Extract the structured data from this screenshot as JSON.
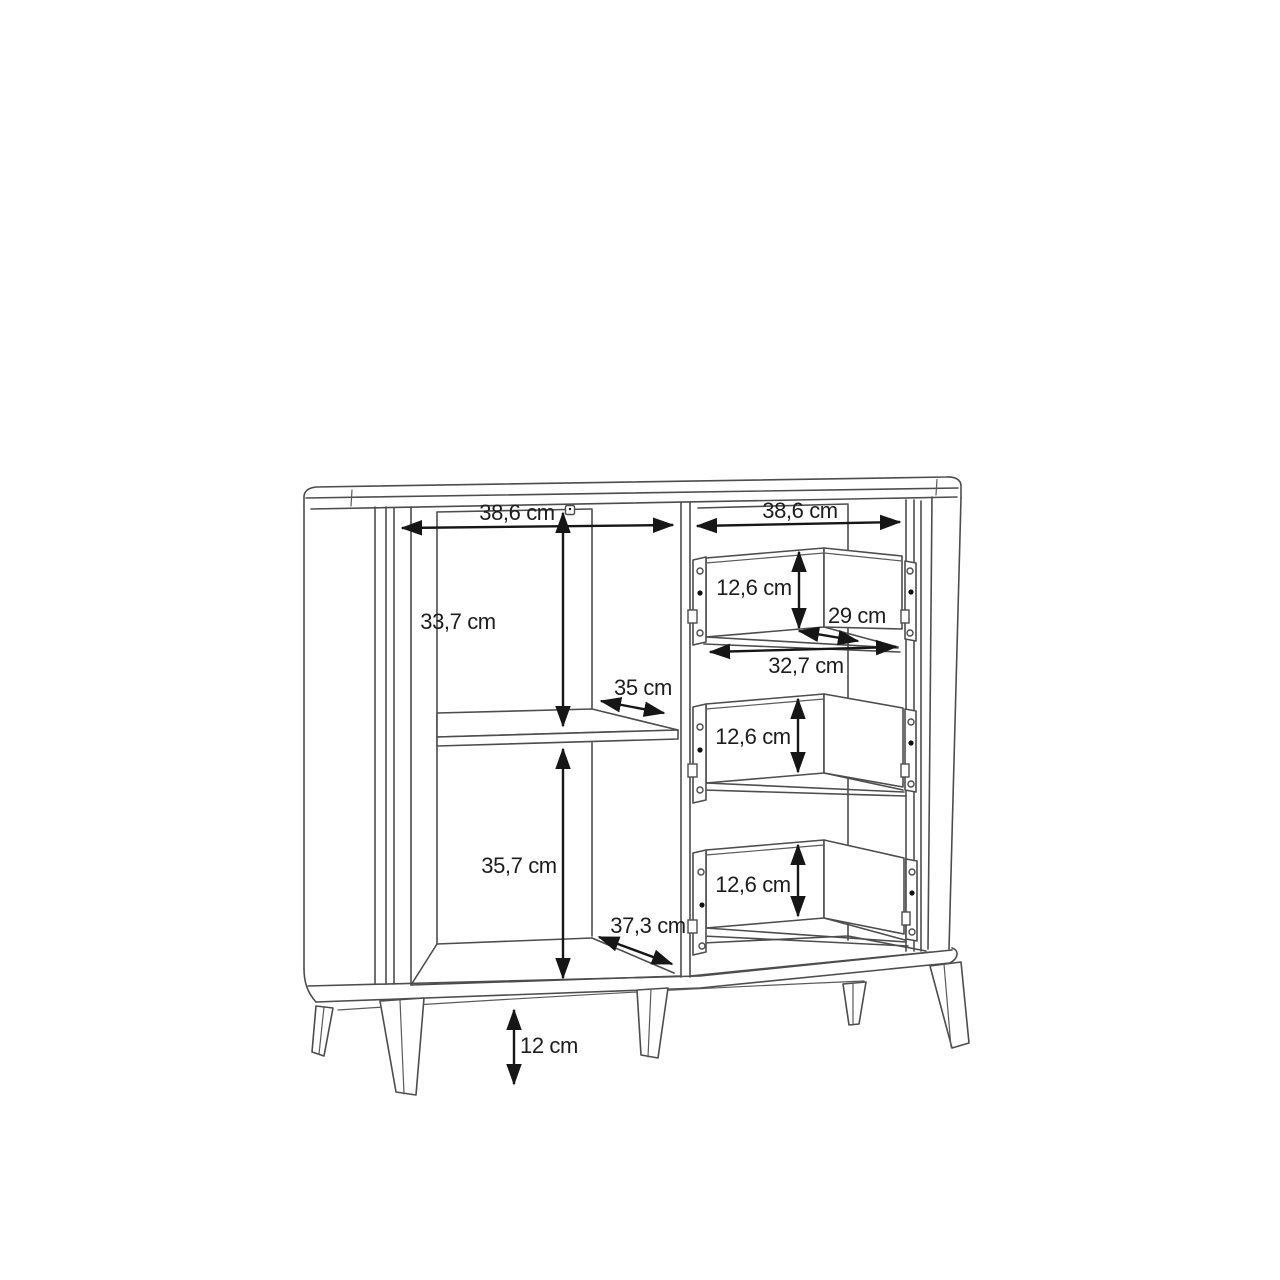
{
  "diagram": {
    "kind": "furniture-dimension-drawing",
    "subject": "sideboard with open shelf compartment, three drawers and splayed legs",
    "unit": "cm",
    "colors": {
      "background": "#ffffff",
      "structure_line": "#4d4d4d",
      "dimension_line": "#161616",
      "label_text": "#1d1d1d"
    },
    "dimensions": {
      "left_width": "38,6 cm",
      "right_width": "38,6 cm",
      "upper_height": "33,7 cm",
      "shelf_depth": "35 cm",
      "lower_height": "35,7 cm",
      "bottom_depth": "37,3 cm",
      "drawer1_height": "12,6 cm",
      "drawer2_height": "12,6 cm",
      "drawer3_height": "12,6 cm",
      "drawer_depth": "29 cm",
      "drawer_width": "32,7 cm",
      "leg_height": "12 cm"
    }
  }
}
